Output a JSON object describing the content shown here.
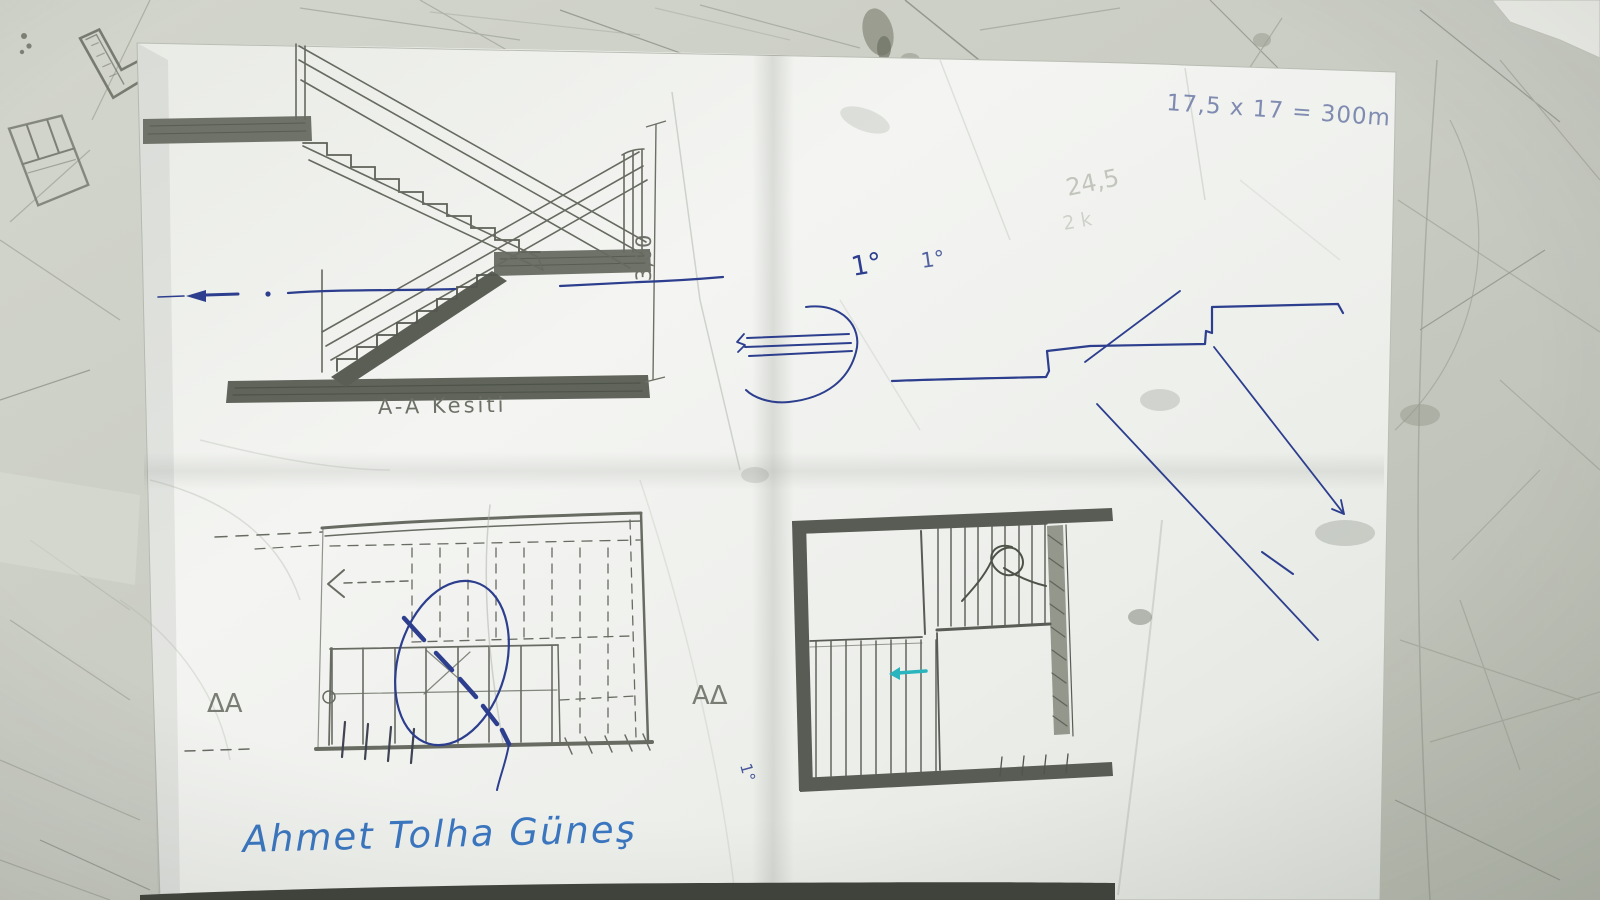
{
  "annotations": {
    "formula_top_right": "17,5 x 17 = 300m",
    "section_title": "A-A Kesiti",
    "height_dimension": "3,00",
    "step_note_large": "1°",
    "step_note_small": "1°",
    "rotated_note": "1°",
    "faint_calc_1": "24,5",
    "faint_calc_2": "2 k",
    "section_marker_left": "ΔA",
    "section_marker_right": "AΔ",
    "signature": "Ahmet Tolha Güneş"
  },
  "scene": {
    "type": "photograph of hand-drawn architectural stair sketches on a folded sheet of paper lying on a scratched worktable",
    "elements": [
      "stair-section-drawing",
      "height-dimension-line",
      "blue-level-line",
      "blue-tread-nosing-detail",
      "blue-step-profile-sketch",
      "floor-plan-left",
      "floor-plan-right",
      "pencil-doodles-on-table",
      "signature"
    ]
  },
  "colors": {
    "table": "#c9ccc3",
    "paper": "#f0f2ee",
    "pencil": "#676b62",
    "pencil_dark": "#585c54",
    "ink_blue": "#2c3e8d",
    "signature_blue": "#3a76c0",
    "formula_blue": "#7480ab",
    "teal": "#2ab4bd",
    "shadow_strip": "#3f433c"
  }
}
